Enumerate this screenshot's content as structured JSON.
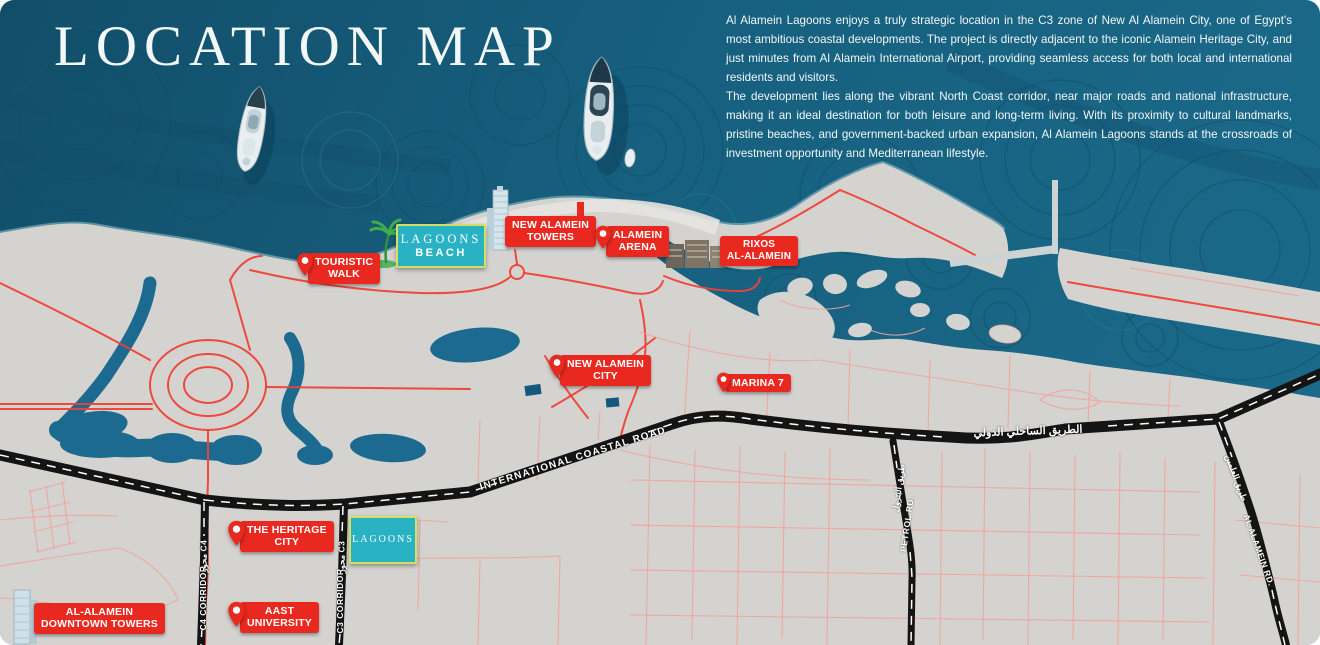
{
  "header": {
    "title": "LOCATION MAP",
    "paragraphs": [
      "Al Alamein Lagoons enjoys a truly strategic location in the C3 zone of New Al Alamein City, one of Egypt's most ambitious coastal developments. The project is directly adjacent to the iconic Alamein Heritage City, and just minutes from Al Alamein International Airport, providing seamless access for both local and international residents and visitors.",
      "The development lies along the vibrant North Coast corridor, near major roads and national infrastructure, making it an ideal destination for both leisure and long-term living. With its proximity to cultural landmarks, pristine beaches, and government-backed urban expansion, Al Alamein Lagoons stands at the crossroads of investment opportunity and Mediterranean lifestyle."
    ]
  },
  "markers": [
    {
      "id": "touristic-walk",
      "lines": [
        "TOURISTIC",
        "WALK"
      ],
      "pin": true
    },
    {
      "id": "new-alamein-towers",
      "lines": [
        "NEW ALAMEIN",
        "TOWERS"
      ],
      "pin": false
    },
    {
      "id": "alamein-arena",
      "lines": [
        "ALAMEIN",
        "ARENA"
      ],
      "pin": true
    },
    {
      "id": "rixos-al-alamein",
      "lines": [
        "RIXOS",
        "AL-ALAMEIN"
      ],
      "pin": false
    },
    {
      "id": "new-alamein-city",
      "lines": [
        "NEW ALAMEIN",
        "CITY"
      ],
      "pin": true
    },
    {
      "id": "marina-7",
      "lines": [
        "MARINA 7"
      ],
      "pin": true
    },
    {
      "id": "the-heritage-city",
      "lines": [
        "THE HERITAGE",
        "CITY"
      ],
      "pin": true
    },
    {
      "id": "aast-university",
      "lines": [
        "AAST",
        "UNIVERSITY"
      ],
      "pin": true
    },
    {
      "id": "al-alamein-downtown-towers",
      "lines": [
        "AL-ALAMEIN",
        "DOWNTOWN TOWERS"
      ],
      "pin": false
    }
  ],
  "brand": {
    "beach": {
      "title": "LAGOONS",
      "subtitle": "BEACH"
    },
    "site": {
      "title": "LAGOONS"
    }
  },
  "roads": {
    "coastal_en": "INTERNATIONAL COASTAL ROAD",
    "coastal_ar": "الطريق الساحلي الدولي",
    "c4_en": "C4 CORRIDOR",
    "c4_ar": "محور C4",
    "c3_en": "C3 CORRIDOR",
    "c3_ar": "محور C3",
    "petrol_en": "PETROL RD.",
    "petrol_ar": "طريق البترول",
    "alamein_en": "AL ALAMEIN RD.",
    "alamein_ar": "طريق العلمين"
  },
  "icons": [
    "map-pin-icon",
    "palm-tree-icon",
    "yacht-icon",
    "skyscraper-icon",
    "hotel-buildings-icon",
    "downtown-towers-icon",
    "pier",
    "flag-marker-icon"
  ],
  "colors": {
    "sea": "#17607F",
    "sea_deep": "#114E69",
    "land": "#D5D3D0",
    "water": "#1C6A8F",
    "marker_red": "#E9291F",
    "road_red": "#EF4136",
    "road_pink": "#F2A39B",
    "highway": "#141414",
    "brand_teal": "#29B2C4",
    "brand_border": "#D5E062",
    "text_light": "#F2F7F8"
  }
}
